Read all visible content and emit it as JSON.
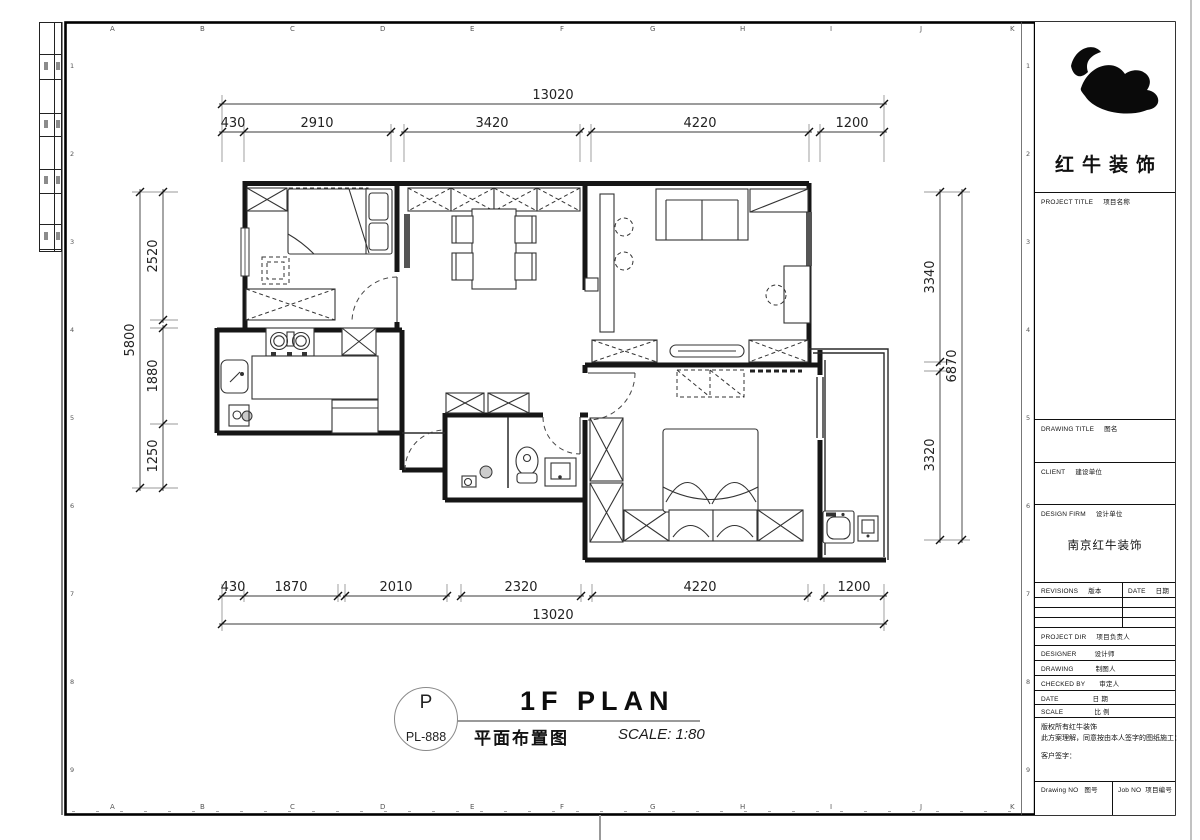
{
  "sheet": {
    "letters": [
      "A",
      "B",
      "C",
      "D",
      "E",
      "F",
      "G",
      "H",
      "I",
      "J",
      "K"
    ],
    "numbers": [
      "1",
      "2",
      "3",
      "4",
      "5",
      "6",
      "7",
      "8",
      "9"
    ]
  },
  "dims": {
    "top_total": "13020",
    "top_segments": [
      "430",
      "2910",
      "3420",
      "4220",
      "1200"
    ],
    "bottom_segments": [
      "430",
      "1870",
      "2010",
      "2320",
      "4220",
      "1200"
    ],
    "bottom_total": "13020",
    "left_total": "5800",
    "left_segments": [
      "2520",
      "1880",
      "1250"
    ],
    "right_segments": [
      "3340",
      "3320"
    ],
    "right_total": "6870"
  },
  "title": {
    "bubble_letter": "P",
    "bubble_code": "PL-888",
    "name_en": "1F PLAN",
    "name_cn": "平面布置图",
    "scale": "SCALE: 1:80"
  },
  "titleblock": {
    "company_cn": "红牛装饰",
    "project_title_en": "PROJECT TITLE",
    "project_title_cn": "项目名称",
    "drawing_title_en": "DRAWING TITLE",
    "drawing_title_cn": "图名",
    "client_en": "CLIENT",
    "client_cn": "建设单位",
    "design_firm_en": "DESIGN FIRM",
    "design_firm_cn": "设计单位",
    "design_firm_value": "南京红牛装饰",
    "revisions_en": "REVISIONS",
    "revisions_cn": "版本",
    "rev_date_en": "DATE",
    "rev_date_cn": "日期",
    "project_dir_en": "PROJECT DIR",
    "project_dir_cn": "项目负责人",
    "designer_en": "DESIGNER",
    "designer_cn": "设计师",
    "drawing_en": "DRAWING",
    "drawing_cn": "制图人",
    "checked_en": "CHECKED BY",
    "checked_cn": "审定人",
    "date_en": "DATE",
    "date_cn": "日 期",
    "scale_en": "SCALE",
    "scale_cn": "比 例",
    "notes": [
      "版权所有红牛装饰",
      "此方案理解，同意按由本人签字的图纸施工：",
      "客户签字："
    ],
    "drawing_no_en": "Drawing NO",
    "drawing_no_cn": "图号",
    "job_no_en": "Job NO",
    "job_no_cn": "项目编号"
  }
}
